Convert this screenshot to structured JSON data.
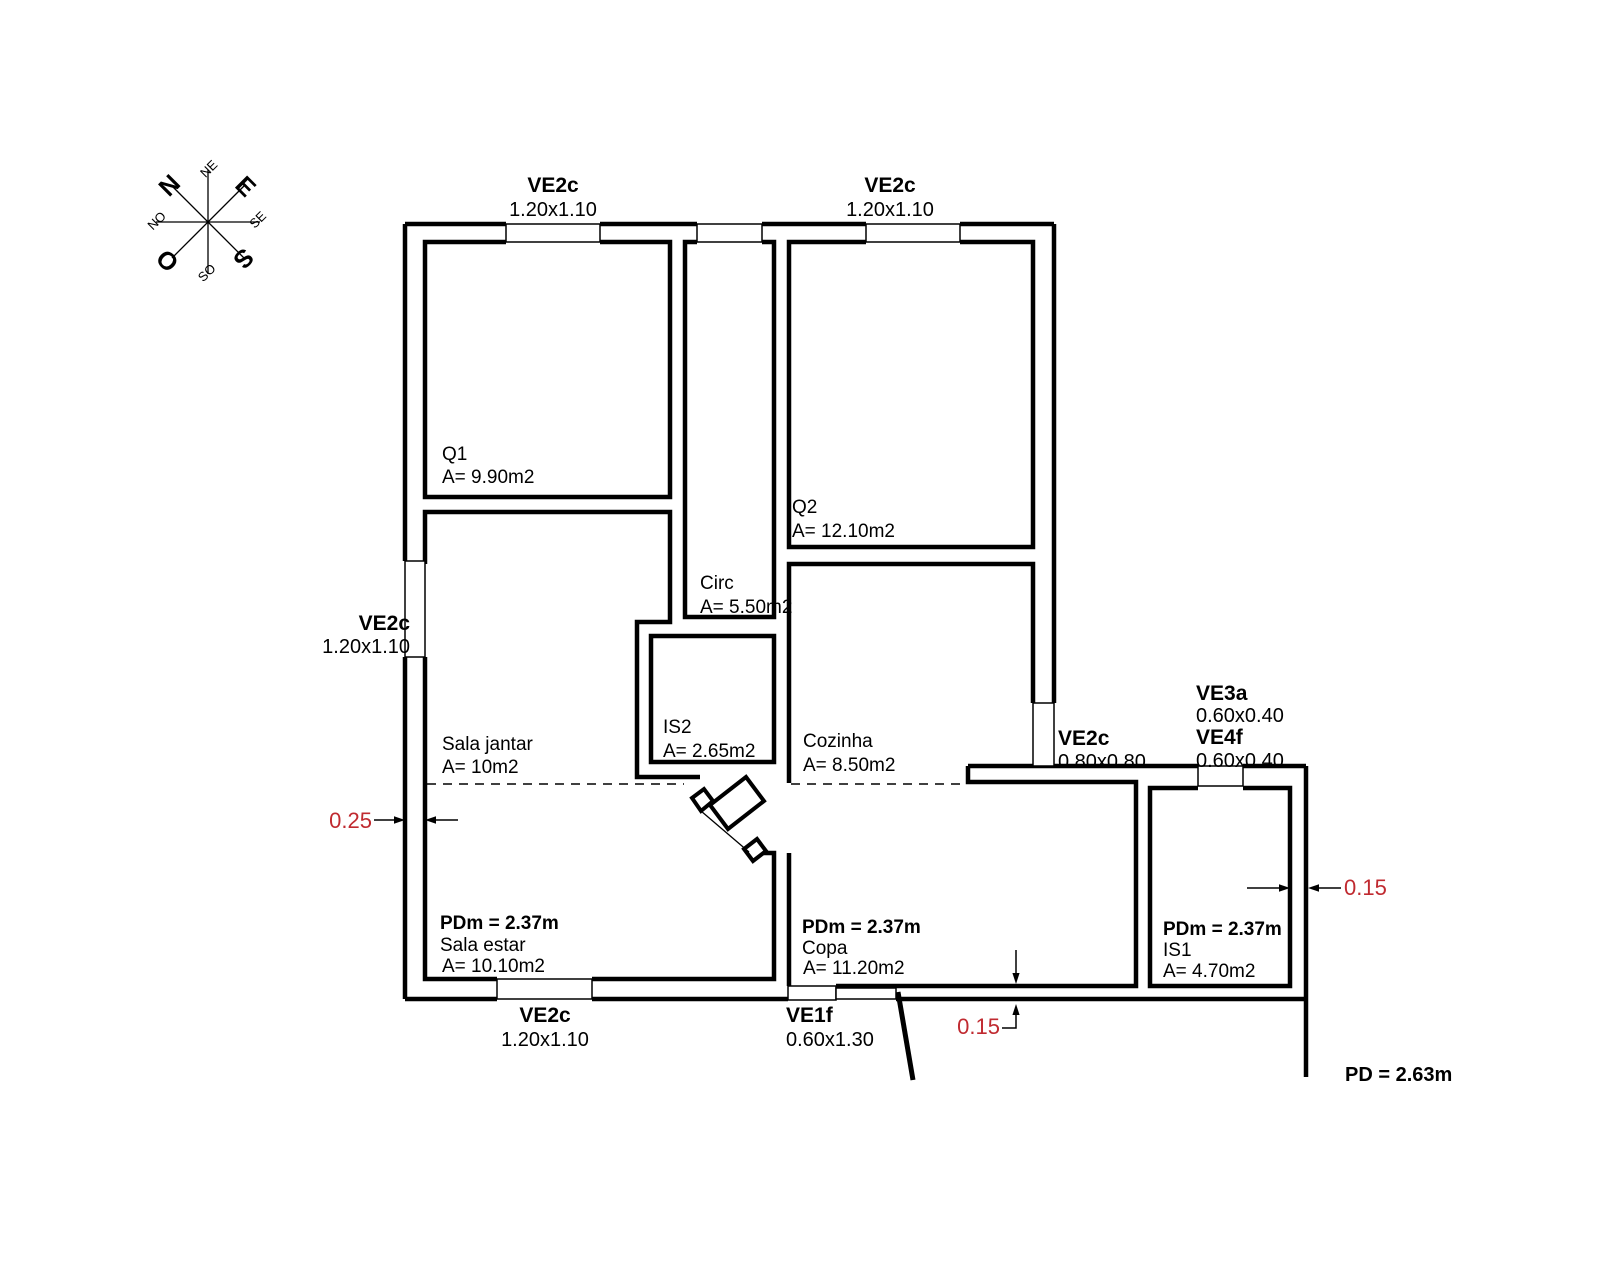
{
  "compass": {
    "n": "N",
    "e": "E",
    "s": "S",
    "o": "O",
    "ne": "NE",
    "se": "SE",
    "so": "SO",
    "no": "NO"
  },
  "windows": {
    "top_left": {
      "name": "VE2c",
      "size": "1.20x1.10"
    },
    "top_right": {
      "name": "VE2c",
      "size": "1.20x1.10"
    },
    "left": {
      "name": "VE2c",
      "size": "1.20x1.10"
    },
    "bottom_left": {
      "name": "VE2c",
      "size": "1.20x1.10"
    },
    "bottom_entry": {
      "name": "VE1f",
      "size": "0.60x1.30"
    },
    "right": {
      "name": "VE2c",
      "size": "0.80x0.80"
    },
    "is1_a": {
      "name": "VE3a",
      "size": "0.60x0.40"
    },
    "is1_b": {
      "name": "VE4f",
      "size": "0.60x0.40"
    }
  },
  "rooms": {
    "q1": {
      "name": "Q1",
      "area": "A= 9.90m2"
    },
    "q2": {
      "name": "Q2",
      "area": "A= 12.10m2"
    },
    "circ": {
      "name": "Circ",
      "area": "A= 5.50m2"
    },
    "is2": {
      "name": "IS2",
      "area": "A= 2.65m2"
    },
    "sala_jantar": {
      "name": "Sala jantar",
      "area": "A= 10m2"
    },
    "sala_estar": {
      "name": "Sala estar",
      "area": "A= 10.10m2",
      "ceiling": "PDm = 2.37m"
    },
    "cozinha": {
      "name": "Cozinha",
      "area": "A= 8.50m2"
    },
    "copa": {
      "name": "Copa",
      "area": "A= 11.20m2",
      "ceiling": "PDm = 2.37m"
    },
    "is1": {
      "name": "IS1",
      "area": "A= 4.70m2",
      "ceiling": "PDm = 2.37m"
    }
  },
  "dimensions": {
    "left_wall": "0.25",
    "right_wall": "0.15",
    "bottom_wall": "0.15",
    "ceiling_height": "PD = 2.63m"
  },
  "colors": {
    "line": "#000000",
    "dimension_text": "#c02a30",
    "background": "#ffffff"
  }
}
